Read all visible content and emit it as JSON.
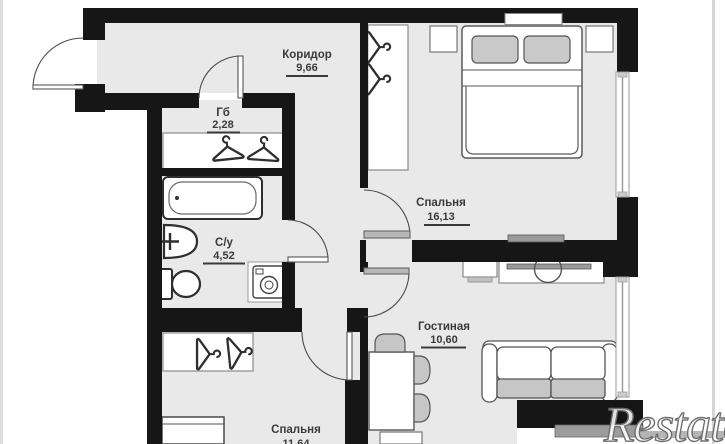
{
  "plan": {
    "rooms": [
      {
        "name": "Коридор",
        "area": "9,66"
      },
      {
        "name": "Гб",
        "area": "2,28"
      },
      {
        "name": "С/у",
        "area": "4,52"
      },
      {
        "name": "Спальня",
        "area": "16,13"
      },
      {
        "name": "Гостиная",
        "area": "10,60"
      },
      {
        "name": "Спальня",
        "area": "11,64"
      }
    ],
    "watermark": "Restate",
    "colors": {
      "wall": "#161616",
      "floor": "#e9e9e9",
      "furniture_gray": "#c6c6c6",
      "label_text": "#3a3a3a",
      "background": "#ffffff"
    }
  }
}
